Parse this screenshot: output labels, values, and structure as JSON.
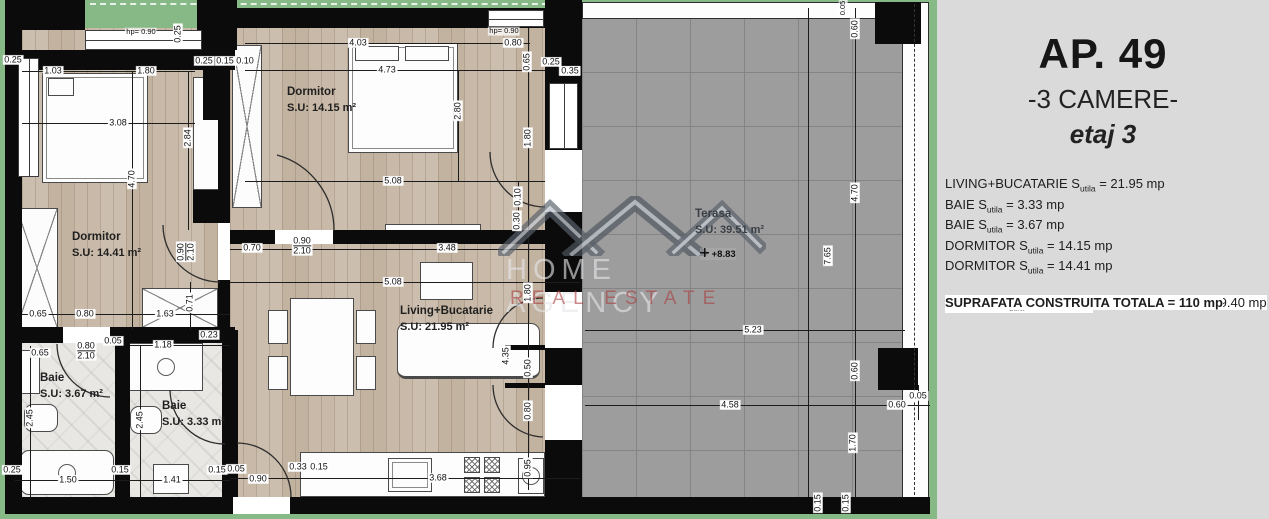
{
  "panel": {
    "title": "AP. 49",
    "subtitle": "-3 CAMERE-",
    "floor_label": "etaj 3",
    "rows": [
      {
        "pre": "LIVING+BUCATARIE S",
        "sub": "utila",
        "post": " = 21.95 mp"
      },
      {
        "pre": "BAIE S",
        "sub": "utila",
        "post": " = 3.33 mp"
      },
      {
        "pre": "BAIE S",
        "sub": "utila",
        "post": " = 3.67 mp"
      },
      {
        "pre": "DORMITOR S",
        "sub": "utila",
        "post": " = 14.15 mp"
      },
      {
        "pre": "DORMITOR S",
        "sub": "utila",
        "post": " = 14.41 mp"
      },
      {
        "pre": "SUPRAFATA UTILA FARA TERASA = 57.53 mp",
        "gap": 1
      },
      {
        "pre": "TERASA S",
        "sub": "utila",
        "post": " = 39.51 mp",
        "gap": 1
      },
      {
        "pre": "SUPRAFATA UTILA TOTALA = 97.04 mp",
        "bold": 1,
        "gap": 1
      },
      {
        "pre": "SUPRAFATA CONSTRUITA FARA TERASA = 69.40 mp",
        "gap": 1
      },
      {
        "pre": "SUPRAFATA CONSTRUITA TOTALA = 110 mp",
        "bold": 1,
        "gap": 1
      }
    ]
  },
  "plan": {
    "rooms": [
      {
        "name": "Dormitor",
        "area": "S.U: 14.41 m²",
        "x": 72,
        "y": 231
      },
      {
        "name": "Dormitor",
        "area": "S.U: 14.15 m²",
        "x": 287,
        "y": 86
      },
      {
        "name": "Living+Bucatarie",
        "area": "S.U:  21.95 m²",
        "x": 400,
        "y": 305
      },
      {
        "name": "Baie",
        "area": "S.U: 3.67 m²",
        "x": 40,
        "y": 372
      },
      {
        "name": "Baie",
        "area": "S.U: 3.33 m²",
        "x": 162,
        "y": 400
      },
      {
        "name": "Terasa",
        "area": "S.U: 39.51 m²",
        "x": 695,
        "y": 208,
        "muted": 1
      }
    ],
    "level_marker": {
      "text": "+8.83",
      "x": 700,
      "y": 248
    },
    "watermark": {
      "line1": "HOME AGENCY",
      "line2": "REAL ESTATE"
    },
    "dims": [
      {
        "t": "0.25",
        "x": 13,
        "y": 60
      },
      {
        "t": "hp= 0.90",
        "x": 141,
        "y": 32,
        "sm": 1
      },
      {
        "t": "0.25",
        "x": 178,
        "y": 34,
        "v": 1
      },
      {
        "t": "1.03",
        "x": 53,
        "y": 71
      },
      {
        "t": "1.80",
        "x": 146,
        "y": 71
      },
      {
        "t": "0.25",
        "x": 204,
        "y": 61
      },
      {
        "t": "0.15",
        "x": 225,
        "y": 61
      },
      {
        "t": "0.10",
        "x": 245,
        "y": 61
      },
      {
        "t": "3.08",
        "x": 118,
        "y": 123
      },
      {
        "t": "2.84",
        "x": 188,
        "y": 138,
        "v": 1
      },
      {
        "t": "4.70",
        "x": 132,
        "y": 179,
        "v": 1
      },
      {
        "t": "0.90",
        "t2": "2.10",
        "x": 186,
        "y": 252,
        "v": 1
      },
      {
        "t": "4.03",
        "x": 358,
        "y": 43
      },
      {
        "t": "hp= 0.90",
        "x": 504,
        "y": 31,
        "sm": 1
      },
      {
        "t": "0.80",
        "x": 513,
        "y": 43
      },
      {
        "t": "4.73",
        "x": 387,
        "y": 70
      },
      {
        "t": "0.65",
        "x": 527,
        "y": 62,
        "v": 1
      },
      {
        "t": "0.25",
        "x": 551,
        "y": 62
      },
      {
        "t": "0.35",
        "x": 569,
        "y": 71
      },
      {
        "t": "2.80",
        "x": 458,
        "y": 111,
        "v": 1
      },
      {
        "t": "1.80",
        "x": 528,
        "y": 138,
        "v": 1
      },
      {
        "t": "5.08",
        "x": 393,
        "y": 181
      },
      {
        "t": "0.10",
        "x": 518,
        "y": 197,
        "v": 1
      },
      {
        "t": "0.30",
        "x": 517,
        "y": 221,
        "v": 1
      },
      {
        "t": "0.70",
        "x": 252,
        "y": 248
      },
      {
        "t": "0.90",
        "t2": "2.10",
        "x": 302,
        "y": 246
      },
      {
        "t": "3.48",
        "x": 447,
        "y": 248
      },
      {
        "t": "5.08",
        "x": 393,
        "y": 282
      },
      {
        "t": "1.80",
        "x": 528,
        "y": 293,
        "v": 1
      },
      {
        "t": "4.35",
        "x": 506,
        "y": 356,
        "v": 1
      },
      {
        "t": "0.50",
        "x": 528,
        "y": 368,
        "v": 1
      },
      {
        "t": "0.80",
        "x": 528,
        "y": 411,
        "v": 1
      },
      {
        "t": "0.95",
        "x": 528,
        "y": 468,
        "v": 1
      },
      {
        "t": "0.05",
        "x": 236,
        "y": 469
      },
      {
        "t": "0.33",
        "x": 298,
        "y": 467
      },
      {
        "t": "0.15",
        "x": 319,
        "y": 467
      },
      {
        "t": "0.90",
        "x": 258,
        "y": 479
      },
      {
        "t": "3.68",
        "x": 438,
        "y": 478
      },
      {
        "t": "0.65",
        "x": 38,
        "y": 314
      },
      {
        "t": "0.80",
        "x": 85,
        "y": 314
      },
      {
        "t": "1.63",
        "x": 165,
        "y": 314
      },
      {
        "t": "0.71",
        "x": 190,
        "y": 303,
        "v": 1
      },
      {
        "t": "0.23",
        "x": 209,
        "y": 335
      },
      {
        "t": "0.05",
        "x": 113,
        "y": 341
      },
      {
        "t": "1.18",
        "x": 163,
        "y": 345
      },
      {
        "t": "0.65",
        "x": 40,
        "y": 353
      },
      {
        "t": "0.80",
        "t2": "2.10",
        "x": 86,
        "y": 351
      },
      {
        "t": "2.45",
        "x": 30,
        "y": 418,
        "v": 1
      },
      {
        "t": "2.45",
        "x": 140,
        "y": 420,
        "v": 1
      },
      {
        "t": "0.25",
        "x": 12,
        "y": 470
      },
      {
        "t": "1.50",
        "x": 68,
        "y": 480
      },
      {
        "t": "0.15",
        "x": 120,
        "y": 470
      },
      {
        "t": "1.41",
        "x": 172,
        "y": 480
      },
      {
        "t": "0.15",
        "x": 217,
        "y": 470
      },
      {
        "t": "0.35",
        "x": 570,
        "y": 71
      },
      {
        "t": "0.05",
        "x": 843,
        "y": 8,
        "v": 1,
        "sm": 1
      },
      {
        "t": "0.60",
        "x": 855,
        "y": 29,
        "v": 1
      },
      {
        "t": "4.70",
        "x": 855,
        "y": 193,
        "v": 1
      },
      {
        "t": "7.65",
        "x": 828,
        "y": 256,
        "v": 1
      },
      {
        "t": "5.23",
        "x": 753,
        "y": 330
      },
      {
        "t": "0.60",
        "x": 855,
        "y": 371,
        "v": 1
      },
      {
        "t": "4.58",
        "x": 730,
        "y": 405
      },
      {
        "t": "0.60",
        "x": 897,
        "y": 405
      },
      {
        "t": "0.05",
        "x": 918,
        "y": 396
      },
      {
        "t": "1.70",
        "x": 853,
        "y": 443,
        "v": 1
      },
      {
        "t": "0.15",
        "x": 818,
        "y": 503,
        "v": 1
      },
      {
        "t": "0.15",
        "x": 846,
        "y": 503,
        "v": 1
      }
    ]
  },
  "colors": {
    "green": "#87b987",
    "panel_bg": "#dadada",
    "wall": "#0b0b0b",
    "tile": "#9d9d9d",
    "wood": "#c8b9a8",
    "watermark_red": "#a83e3e"
  }
}
